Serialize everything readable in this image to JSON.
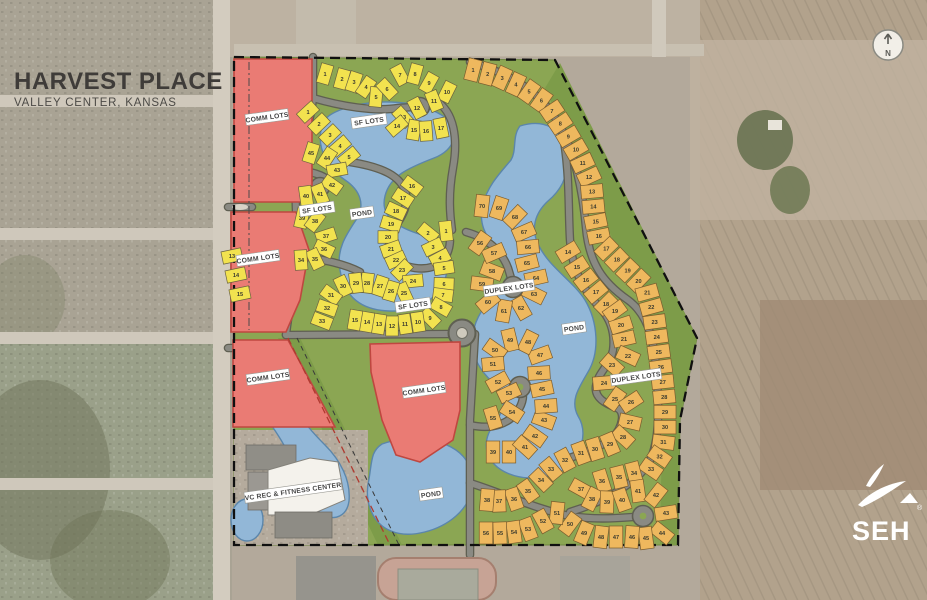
{
  "title": {
    "main": "HARVEST PLACE",
    "subtitle": "VALLEY CENTER, KANSAS"
  },
  "compass": {
    "label": "N"
  },
  "logo": {
    "name": "SEH",
    "registered": "®"
  },
  "colors": {
    "comm_lots": "#ea7b74",
    "sf_lots": "#f2e24f",
    "duplex_lots": "#eeb85e",
    "pond": "#92b7d7",
    "open_space": "#8ba653",
    "road": "#8a8a83",
    "boundary": "#111111"
  },
  "map_labels": [
    {
      "id": "comm-lots-1",
      "text": "COMM LOTS",
      "x": 267,
      "y": 117
    },
    {
      "id": "comm-lots-2",
      "text": "COMM LOTS",
      "x": 258,
      "y": 258
    },
    {
      "id": "comm-lots-3",
      "text": "COMM LOTS",
      "x": 268,
      "y": 377
    },
    {
      "id": "comm-lots-4",
      "text": "COMM LOTS",
      "x": 424,
      "y": 390
    },
    {
      "id": "sf-lots-1",
      "text": "SF LOTS",
      "x": 369,
      "y": 121
    },
    {
      "id": "sf-lots-2",
      "text": "SF LOTS",
      "x": 317,
      "y": 209
    },
    {
      "id": "sf-lots-3",
      "text": "SF LOTS",
      "x": 413,
      "y": 305
    },
    {
      "id": "duplex-lots-1",
      "text": "DUPLEX LOTS",
      "x": 509,
      "y": 288
    },
    {
      "id": "duplex-lots-2",
      "text": "DUPLEX LOTS",
      "x": 636,
      "y": 377
    },
    {
      "id": "pond-1",
      "text": "POND",
      "x": 362,
      "y": 213
    },
    {
      "id": "pond-2",
      "text": "POND",
      "x": 574,
      "y": 328
    },
    {
      "id": "pond-3",
      "text": "POND",
      "x": 431,
      "y": 494
    },
    {
      "id": "rec-center",
      "text": "VC REC & FITNESS CENTER",
      "x": 293,
      "y": 491
    }
  ],
  "lot_clusters": [
    {
      "id": "sf-north-row",
      "category": "single-family",
      "numbers": [
        1,
        2,
        3,
        4,
        5,
        6,
        7,
        8,
        9,
        10
      ]
    },
    {
      "id": "sf-north-culdesac",
      "category": "single-family",
      "numbers": [
        11,
        12,
        13,
        14,
        15,
        16,
        17
      ]
    },
    {
      "id": "sf-west-upper",
      "category": "single-family",
      "numbers": [
        1,
        2,
        3,
        4,
        5
      ]
    },
    {
      "id": "sf-west-culdesac",
      "category": "single-family",
      "numbers": [
        45,
        44,
        43,
        42,
        41,
        40
      ]
    },
    {
      "id": "sf-west-column",
      "category": "single-family",
      "numbers": [
        39,
        38,
        37,
        36,
        35,
        34
      ]
    },
    {
      "id": "sf-west-strip",
      "category": "single-family",
      "numbers": [
        13,
        14,
        15
      ]
    },
    {
      "id": "sf-central-east-column",
      "category": "single-family",
      "numbers": [
        1,
        2,
        3,
        4,
        5,
        6,
        7,
        8,
        9
      ]
    },
    {
      "id": "sf-central-south-row",
      "category": "single-family",
      "numbers": [
        10,
        11,
        12,
        13,
        14,
        15
      ]
    },
    {
      "id": "sf-central-west-column",
      "category": "single-family",
      "numbers": [
        16,
        17,
        18,
        19,
        20,
        21,
        22
      ]
    },
    {
      "id": "sf-central-arc",
      "category": "single-family",
      "numbers": [
        23,
        24,
        25,
        26,
        27,
        28,
        29,
        30,
        31,
        32,
        33
      ]
    },
    {
      "id": "dx-east-outer",
      "category": "duplex",
      "numbers": [
        1,
        2,
        3,
        4,
        5,
        6,
        7,
        8,
        9,
        10,
        11,
        12,
        13,
        14,
        15,
        16,
        17,
        18,
        19,
        20,
        21,
        22,
        23,
        24,
        25,
        26,
        27,
        28,
        29,
        30,
        31,
        32,
        33
      ]
    },
    {
      "id": "dx-southeast-culdesac",
      "category": "duplex",
      "numbers": [
        34,
        35,
        36,
        37,
        38,
        39,
        40,
        41,
        42,
        43,
        44,
        45,
        46
      ]
    },
    {
      "id": "dx-south-row",
      "category": "duplex",
      "numbers": [
        47,
        48,
        49,
        50,
        51,
        52,
        53,
        54,
        55,
        56
      ]
    },
    {
      "id": "dx-east-inner",
      "category": "duplex",
      "numbers": [
        14,
        15,
        16,
        17,
        18,
        19,
        20,
        21,
        22,
        23,
        24,
        25,
        26,
        27,
        28,
        29,
        30,
        31,
        32,
        33,
        34,
        35,
        36,
        37,
        38
      ]
    },
    {
      "id": "dx-south-stub",
      "category": "duplex",
      "numbers": [
        39,
        40
      ]
    },
    {
      "id": "dx-west-upper-hook",
      "category": "duplex",
      "numbers": [
        70,
        69,
        68,
        67,
        66,
        65,
        64,
        63,
        62,
        61,
        60,
        59,
        58,
        57,
        56
      ]
    },
    {
      "id": "dx-west-lower-hook",
      "category": "duplex",
      "numbers": [
        41,
        42,
        43,
        44,
        45,
        46,
        47,
        48,
        49,
        50,
        51,
        52,
        53,
        54,
        55
      ]
    }
  ]
}
